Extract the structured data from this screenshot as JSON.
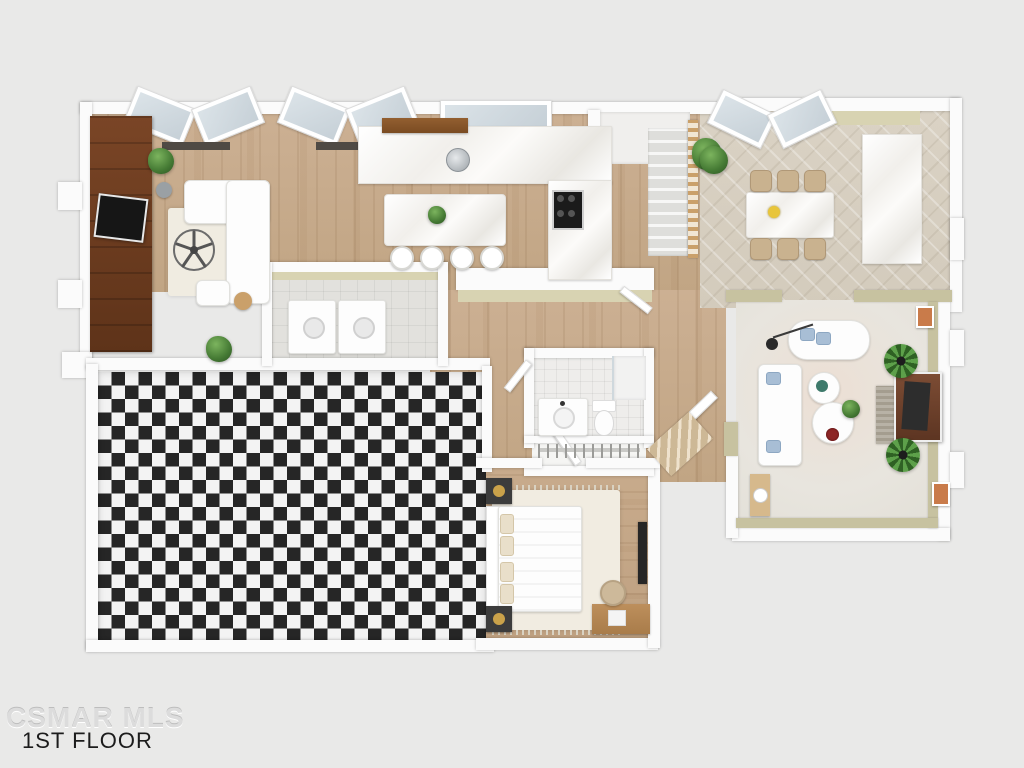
{
  "watermark": {
    "mls": "CSMAR MLS",
    "floor_label": "1ST FLOOR"
  },
  "palette": {
    "background": "#e9e9e8",
    "wall_white": "#fbfbfb",
    "wall_khaki": "#c7c2a0",
    "wood_floor": "#c8ad90",
    "dark_wood_cabinet": "#6e4124",
    "dining_tile": "#d8d0c2",
    "family_carpet": "#e8e5de",
    "checker_dark": "#262626",
    "checker_light": "#f3f3f3",
    "plant_green": "#4e8040",
    "chair_tan": "#c9b28f",
    "pillow_blue": "#a8bed5",
    "stove_black": "#1c1c1c"
  },
  "rooms": [
    {
      "name": "living-room",
      "furniture": [
        "dark-media-wall",
        "tv",
        "sectional-sofa",
        "area-rug",
        "ceiling-fan",
        "ottoman",
        "side-table",
        "plants",
        "bay-windows"
      ]
    },
    {
      "name": "kitchen",
      "furniture": [
        "marble-counter",
        "sink",
        "wood-shelf",
        "range-stove",
        "island",
        "bar-stools",
        "island-plant"
      ]
    },
    {
      "name": "staircase",
      "furniture": [
        "stairs",
        "wood-railing",
        "plant"
      ]
    },
    {
      "name": "dining-room",
      "furniture": [
        "marble-dining-table",
        "six-tan-chairs",
        "flower-centerpiece",
        "marble-buffet",
        "plant",
        "bay-windows"
      ]
    },
    {
      "name": "family-room",
      "furniture": [
        "daybed-chaise",
        "sofa",
        "two-round-coffee-tables",
        "red-bowl",
        "tv-with-wood-frame",
        "stone-hearth-rug",
        "palm-plants",
        "arc-lamp",
        "wood-console-lamp",
        "wall-art"
      ]
    },
    {
      "name": "laundry-room",
      "furniture": [
        "washer",
        "dryer"
      ]
    },
    {
      "name": "bathroom",
      "furniture": [
        "vanity-sink",
        "toilet",
        "shower"
      ]
    },
    {
      "name": "closet",
      "furniture": [
        "hanging-rod-with-hangers"
      ]
    },
    {
      "name": "bedroom",
      "furniture": [
        "bed-with-headboard",
        "cream-pillows",
        "dark-nightstands",
        "fringed-rug",
        "wood-desk",
        "desk-chair",
        "wall-tv"
      ]
    },
    {
      "name": "checkered-room",
      "furniture": [
        "black-white-marble-checkerboard-floor"
      ]
    },
    {
      "name": "entry",
      "furniture": [
        "wood-steps",
        "door"
      ]
    }
  ]
}
